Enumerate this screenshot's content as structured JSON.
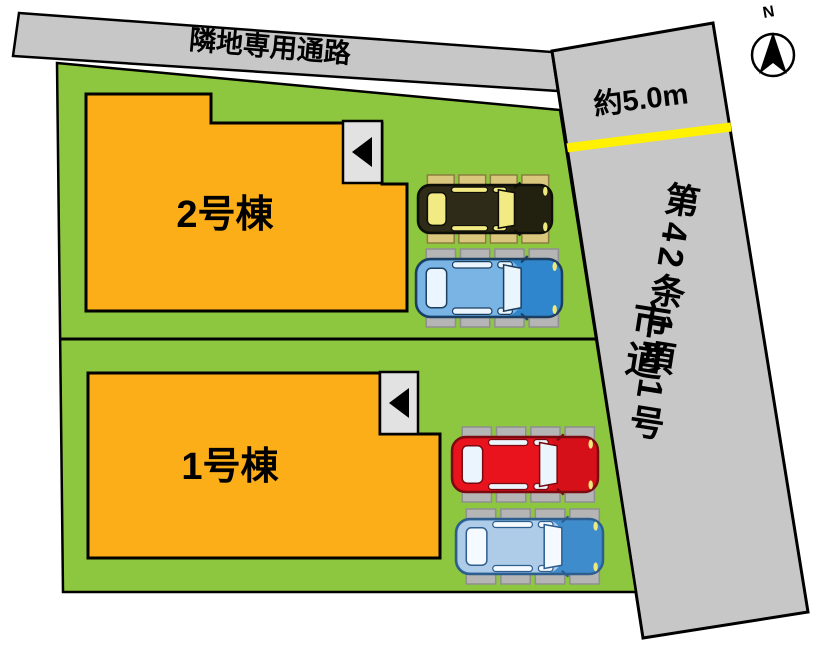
{
  "passage": {
    "label": "隣地専用通路"
  },
  "road": {
    "width_label": "約5.0m",
    "name_main": "第42条1項1号",
    "name_sub": "市道",
    "surface_color": "#C7C7C7",
    "marking_color": "#FFF100"
  },
  "compass": {
    "label": "N"
  },
  "site": {
    "ground_color": "#8DC63F",
    "building_color": "#FBAE17"
  },
  "buildings": [
    {
      "id": "building-2",
      "label": "2号棟"
    },
    {
      "id": "building-1",
      "label": "1号棟"
    }
  ],
  "cars": [
    {
      "name": "car-black",
      "x": 418,
      "y": 185,
      "w": 134,
      "h": 48,
      "body": "#2E2C18",
      "front": "#22200F",
      "window": "#F2EA82",
      "stroke": "#0E0E08",
      "pad": "#D8C77C",
      "padStroke": "#8A7E3E"
    },
    {
      "name": "car-blue",
      "x": 416,
      "y": 259,
      "w": 146,
      "h": 58,
      "body": "#79B4E4",
      "front": "#2F86CC",
      "window": "#EAF5FD",
      "stroke": "#1C3E60",
      "pad": "#B5B5B5",
      "padStroke": "#8F8F8F"
    },
    {
      "name": "car-red",
      "x": 452,
      "y": 437,
      "w": 146,
      "h": 55,
      "body": "#E8131C",
      "front": "#D61019",
      "window": "#EAF5FD",
      "stroke": "#7A0A0F",
      "pad": "#B5B5B5",
      "padStroke": "#8F8F8F"
    },
    {
      "name": "car-lightblue",
      "x": 456,
      "y": 519,
      "w": 147,
      "h": 55,
      "body": "#AECBE8",
      "front": "#3E8CCC",
      "window": "#F4FAFF",
      "stroke": "#2E5E8E",
      "pad": "#B5B5B5",
      "padStroke": "#8F8F8F"
    }
  ]
}
